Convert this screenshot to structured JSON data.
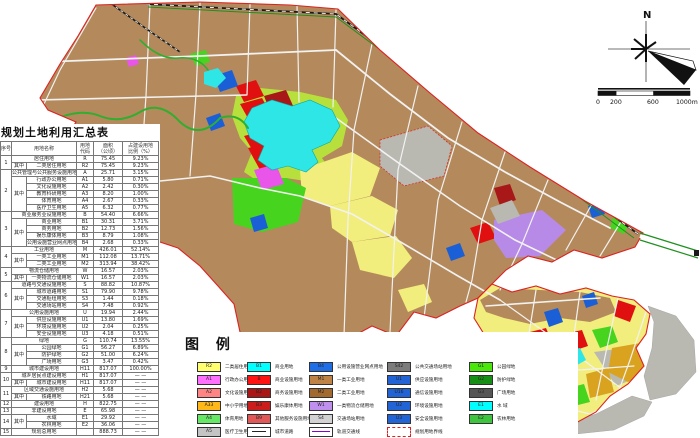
{
  "title": "规划土地利用汇总表",
  "north_label": "N",
  "scalebar": {
    "labels": [
      "0",
      "200",
      "600",
      "1000m"
    ]
  },
  "table": {
    "headers": [
      "序号",
      "用地名称",
      "用地\n代码",
      "面积\n（公顷）",
      "占建设用地\n比例（%）"
    ],
    "rows": [
      {
        "n": "1",
        "ns": 2,
        "name": "居住用地",
        "w": 2,
        "code": "R",
        "area": "75.45",
        "pct": "9.23%"
      },
      {
        "s": "其中",
        "ss": 1,
        "name": "二类居住用地",
        "code": "R2",
        "area": "75.45",
        "pct": "9.23%"
      },
      {
        "n": "2",
        "ns": 6,
        "name": "公共管理与公共服务设施用地",
        "w": 2,
        "code": "A",
        "area": "25.71",
        "pct": "3.15%"
      },
      {
        "s": "其中",
        "ss": 5,
        "name": "行政办公用地",
        "code": "A1",
        "area": "5.80",
        "pct": "0.71%"
      },
      {
        "name": "文化设施用地",
        "code": "A2",
        "area": "2.42",
        "pct": "0.30%"
      },
      {
        "name": "教育科研用地",
        "code": "A3",
        "area": "8.20",
        "pct": "1.00%"
      },
      {
        "name": "体育用地",
        "code": "A4",
        "area": "2.67",
        "pct": "0.33%"
      },
      {
        "name": "医疗卫生用地",
        "code": "A5",
        "area": "6.32",
        "pct": "0.77%"
      },
      {
        "n": "3",
        "ns": 5,
        "name": "商业服务业设施用地",
        "w": 2,
        "code": "B",
        "area": "54.40",
        "pct": "6.66%"
      },
      {
        "s": "其中",
        "ss": 4,
        "name": "商业用地",
        "code": "B1",
        "area": "30.31",
        "pct": "3.71%"
      },
      {
        "name": "商务用地",
        "code": "B2",
        "area": "12.73",
        "pct": "1.56%"
      },
      {
        "name": "娱乐康体用地",
        "code": "B3",
        "area": "8.79",
        "pct": "1.08%"
      },
      {
        "name": "公用设施营业网点用地",
        "code": "B4",
        "area": "2.68",
        "pct": "0.33%"
      },
      {
        "n": "4",
        "ns": 3,
        "name": "工业用地",
        "w": 2,
        "code": "M",
        "area": "426.01",
        "pct": "52.14%"
      },
      {
        "s": "其中",
        "ss": 2,
        "name": "一类工业用地",
        "code": "M1",
        "area": "112.08",
        "pct": "13.71%"
      },
      {
        "name": "二类工业用地",
        "code": "M2",
        "area": "313.94",
        "pct": "38.42%"
      },
      {
        "n": "5",
        "ns": 2,
        "name": "物流仓储用地",
        "w": 2,
        "code": "W",
        "area": "16.57",
        "pct": "2.03%"
      },
      {
        "s": "其中",
        "ss": 1,
        "name": "一类物流仓储用地",
        "code": "W1",
        "area": "16.57",
        "pct": "2.03%"
      },
      {
        "n": "6",
        "ns": 4,
        "name": "道路与交通设施用地",
        "w": 2,
        "code": "S",
        "area": "88.82",
        "pct": "10.87%"
      },
      {
        "s": "其中",
        "ss": 3,
        "name": "城市道路用地",
        "code": "S1",
        "area": "79.90",
        "pct": "9.78%"
      },
      {
        "name": "交通枢纽用地",
        "code": "S3",
        "area": "1.44",
        "pct": "0.18%"
      },
      {
        "name": "交通场站用地",
        "code": "S4",
        "area": "7.48",
        "pct": "0.92%"
      },
      {
        "n": "7",
        "ns": 4,
        "name": "公用设施用地",
        "w": 2,
        "code": "U",
        "area": "19.94",
        "pct": "2.44%"
      },
      {
        "s": "其中",
        "ss": 3,
        "name": "供应设施用地",
        "code": "U1",
        "area": "13.80",
        "pct": "1.69%"
      },
      {
        "name": "环境设施用地",
        "code": "U2",
        "area": "2.04",
        "pct": "0.25%"
      },
      {
        "name": "安全设施用地",
        "code": "U3",
        "area": "4.18",
        "pct": "0.51%"
      },
      {
        "n": "8",
        "ns": 4,
        "name": "绿地",
        "w": 2,
        "code": "G",
        "area": "110.74",
        "pct": "13.55%"
      },
      {
        "s": "其中",
        "ss": 3,
        "name": "公园绿地",
        "code": "G1",
        "area": "56.27",
        "pct": "6.89%"
      },
      {
        "name": "防护绿地",
        "code": "G2",
        "area": "51.00",
        "pct": "6.24%"
      },
      {
        "name": "广场用地",
        "code": "G3",
        "area": "3.47",
        "pct": "0.42%"
      },
      {
        "n": "9",
        "ns": 1,
        "name": "城市建设用地",
        "w": 2,
        "code": "H11",
        "area": "817.07",
        "pct": "100.00%"
      },
      {
        "n": "10",
        "ns": 2,
        "name": "城乡居民点建设用地",
        "w": 2,
        "code": "H1",
        "area": "817.07",
        "pct": "— —"
      },
      {
        "s": "其中",
        "ss": 1,
        "name": "城市建设用地",
        "code": "H11",
        "area": "817.07",
        "pct": "— —"
      },
      {
        "n": "11",
        "ns": 2,
        "name": "区域交通设施用地",
        "w": 2,
        "code": "H2",
        "area": "5.68",
        "pct": "— —"
      },
      {
        "s": "其中",
        "ss": 1,
        "name": "铁路用地",
        "code": "H21",
        "area": "5.68",
        "pct": "— —"
      },
      {
        "n": "12",
        "ns": 1,
        "name": "建设用地",
        "w": 2,
        "code": "H",
        "area": "822.75",
        "pct": "— —"
      },
      {
        "n": "13",
        "ns": 1,
        "name": "非建设用地",
        "w": 2,
        "code": "E",
        "area": "65.98",
        "pct": "— —"
      },
      {
        "n": "14",
        "ns": 2,
        "s": "其中",
        "ss": 2,
        "name": "水域",
        "code": "E1",
        "area": "29.92",
        "pct": "— —"
      },
      {
        "name": "农林用地",
        "code": "E2",
        "area": "36.06",
        "pct": "— —"
      },
      {
        "n": "15",
        "ns": 1,
        "name": "规划总用地",
        "w": 2,
        "code": "",
        "area": "888.73",
        "pct": "— —"
      }
    ]
  },
  "legend": {
    "title": "图 例",
    "columns": [
      {
        "x": 14,
        "items": [
          {
            "type": "swatch",
            "code": "R2",
            "color": "#ffff70",
            "label": "二类居住用地"
          },
          {
            "type": "swatch",
            "code": "A1",
            "color": "#ff70ff",
            "label": "行政办公用地"
          },
          {
            "type": "swatch",
            "code": "A2",
            "color": "#ff8585",
            "label": "文化设施用地"
          },
          {
            "type": "swatch",
            "code": "A33",
            "color": "#ffb818",
            "label": "中小学用地"
          },
          {
            "type": "swatch",
            "code": "A4",
            "color": "#66e866",
            "label": "体育用地"
          },
          {
            "type": "swatch",
            "code": "A5",
            "color": "#c4c4c4",
            "label": "医疗卫生用地"
          }
        ]
      },
      {
        "x": 64,
        "items": [
          {
            "type": "swatch",
            "code": "B1",
            "color": "#00ffff",
            "label": "商业用地"
          },
          {
            "type": "swatch",
            "code": "B",
            "color": "#ff1212",
            "label": "商业设施用地"
          },
          {
            "type": "swatch",
            "code": "B2",
            "color": "#aa1616",
            "label": "商务设施用地"
          },
          {
            "type": "swatch",
            "code": "B3",
            "color": "#cc1d1d",
            "label": "娱乐康体用地"
          },
          {
            "type": "swatch",
            "code": "B9",
            "color": "#e05858",
            "label": "其他服务设施用地"
          },
          {
            "type": "road",
            "label": "城市道路"
          }
        ]
      },
      {
        "x": 126,
        "items": [
          {
            "type": "swatch",
            "code": "B4",
            "color": "#1e6ee8",
            "label": "公用设施营业网点用地"
          },
          {
            "type": "swatch",
            "code": "M1",
            "color": "#bf8445",
            "label": "一类工业用地"
          },
          {
            "type": "swatch",
            "code": "M2",
            "color": "#a26a2e",
            "label": "二类工业用地"
          },
          {
            "type": "swatch",
            "code": "W1",
            "color": "#bf90ee",
            "label": "一类物流仓储用地"
          },
          {
            "type": "swatch",
            "code": "S4",
            "color": "#d2d2d2",
            "label": "交通场站用地"
          },
          {
            "type": "rail",
            "label": "轨道交通线"
          }
        ]
      },
      {
        "x": 204,
        "items": [
          {
            "type": "swatch",
            "code": "S42",
            "color": "#7c7c7c",
            "label": "公共交通场站用地"
          },
          {
            "type": "swatch",
            "code": "U1",
            "color": "#2263d6",
            "label": "供应设施用地"
          },
          {
            "type": "swatch",
            "code": "U16",
            "color": "#2263d6",
            "label": "通信设施用地"
          },
          {
            "type": "swatch",
            "code": "U2",
            "color": "#2263d6",
            "label": "环境设施用地"
          },
          {
            "type": "swatch",
            "code": "U3",
            "color": "#2263d6",
            "label": "安全设施用地"
          },
          {
            "type": "boundary",
            "label": "规划用地界线"
          }
        ]
      },
      {
        "x": 286,
        "items": [
          {
            "type": "swatch",
            "code": "G1",
            "color": "#4ae80a",
            "label": "公园绿地"
          },
          {
            "type": "swatch",
            "code": "G2",
            "color": "#178f17",
            "label": "防护绿地"
          },
          {
            "type": "swatch",
            "code": "G3",
            "color": "#565656",
            "label": "广场用地"
          },
          {
            "type": "swatch",
            "code": "E1",
            "color": "#00ffff",
            "label": "水 域"
          },
          {
            "type": "swatch",
            "code": "E2",
            "color": "#3fc43f",
            "label": "农林用地"
          }
        ]
      }
    ]
  },
  "map": {
    "palette": {
      "land": "#b48a5c",
      "residential": "#f2ee7d",
      "water": "#2ee6e6",
      "park": "#46d41f",
      "marsh": "#b8e03c",
      "commercial": "#e01010",
      "commercial_dark": "#a81818",
      "admin": "#e855e8",
      "utility": "#1b5fd6",
      "logistics": "#b78ae8",
      "gold": "#d9a31f",
      "gray": "#b9b9b2",
      "road": "#f2f2f2",
      "river": "#2fae2f",
      "rail": "#1a1a1a",
      "boundary": "#dd2222",
      "green_line": "#1f8f1f"
    }
  }
}
